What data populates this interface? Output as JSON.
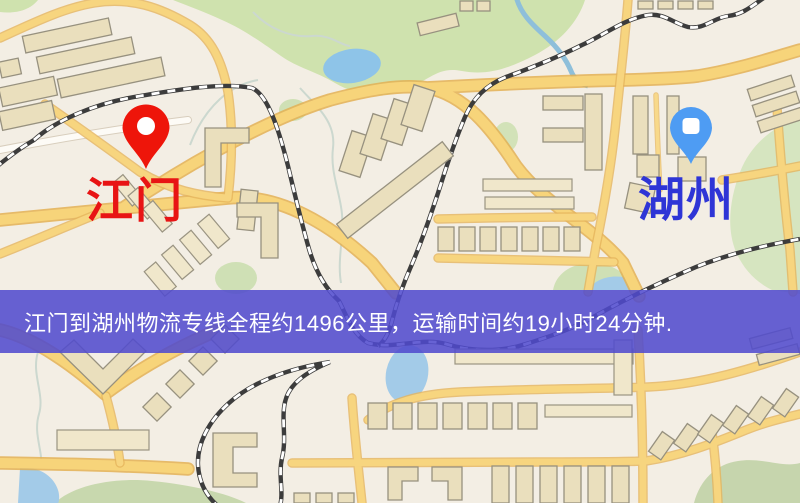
{
  "graphic": {
    "type": "logistics-route-map",
    "description_visible": false
  },
  "origin": {
    "name": "江门",
    "label_color": "#e81414",
    "pin_color": "#ee150a",
    "pin_style": "red-round-marker"
  },
  "destination": {
    "name": "湖州",
    "label_color": "#2e35d6",
    "pin_color": "#4e9cf3",
    "pin_style": "blue-round-marker"
  },
  "banner": {
    "text": "江门到湖州物流专线全程约1496公里，运输时间约19小时24分钟.",
    "bg_color": "#504bce",
    "text_color": "#ffffff"
  },
  "route_info": {
    "distance_km": "1496",
    "duration_hours": "19",
    "duration_minutes": "24"
  },
  "map": {
    "background": "#f3eee4",
    "road_fill": "#f7d47a",
    "road_casing": "#e3b054",
    "building_fill": "#eadfbd",
    "building_stroke": "#97917f",
    "park_green": "#cfe2ae",
    "muted_green": "#c6d5ad",
    "water_blue": "#96c5e6",
    "railway_dark": "#3c3c3c",
    "features": [
      "buildings",
      "yellow roads",
      "railways",
      "park",
      "lake",
      "river",
      "ponds",
      "green areas"
    ]
  }
}
